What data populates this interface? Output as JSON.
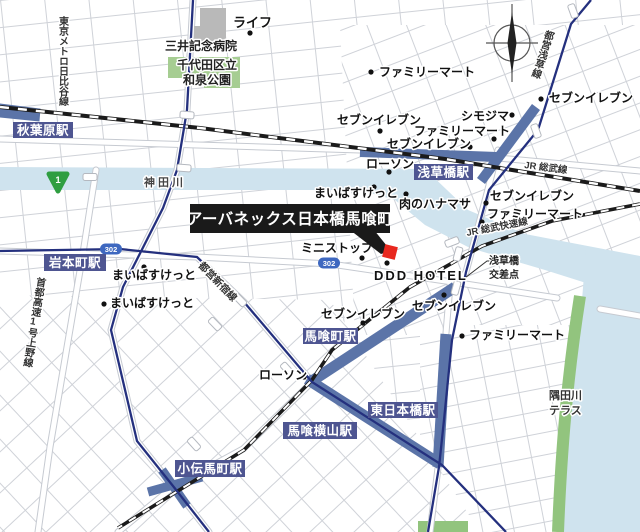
{
  "map": {
    "callout": {
      "text": "アーバネックス日本橋馬喰町"
    },
    "colors": {
      "station_box": "#4e5591",
      "band": "#5b74a8",
      "metro_line": "#24307e",
      "river": "#cfe3ee",
      "park": "#a6cd92",
      "riverside": "#92c47e",
      "marker_red": "#e8281e",
      "callout_bg": "#1a1a1a",
      "shield_green": "#2f9e41",
      "shield_blue": "#3e68c0",
      "building": "#b9b9b9"
    },
    "stations": [
      {
        "name": "秋葉原駅",
        "x": 13,
        "y": 122,
        "w": 60,
        "h": 16
      },
      {
        "name": "岩本町駅",
        "x": 44,
        "y": 254,
        "w": 62,
        "h": 17
      },
      {
        "name": "浅草橋駅",
        "x": 414,
        "y": 164,
        "w": 59,
        "h": 16
      },
      {
        "name": "馬喰町駅",
        "x": 303,
        "y": 328,
        "w": 55,
        "h": 16
      },
      {
        "name": "馬喰横山駅",
        "x": 283,
        "y": 422,
        "w": 74,
        "h": 17
      },
      {
        "name": "東日本橋駅",
        "x": 368,
        "y": 402,
        "w": 70,
        "h": 16
      },
      {
        "name": "小伝馬町駅",
        "x": 175,
        "y": 460,
        "w": 70,
        "h": 17
      }
    ],
    "pois": [
      {
        "label": "ライフ",
        "tx": 233,
        "ty": 27,
        "dx": 250,
        "dy": 33,
        "s": 13
      },
      {
        "label": "ファミリーマート",
        "tx": 379,
        "ty": 76,
        "dx": 371,
        "dy": 72
      },
      {
        "label": "セブンイレブン",
        "tx": 549,
        "ty": 102,
        "dx": 541,
        "dy": 99
      },
      {
        "label": "シモジマ",
        "tx": 461,
        "ty": 120,
        "dx": 512,
        "dy": 115
      },
      {
        "label": "セブンイレブン",
        "tx": 337,
        "ty": 124,
        "dx": 380,
        "dy": 131
      },
      {
        "label": "ファミリーマート",
        "tx": 414,
        "ty": 135,
        "dx": 494,
        "dy": 139
      },
      {
        "label": "セブンイレブン",
        "tx": 387,
        "ty": 148,
        "dx": 470,
        "dy": 147
      },
      {
        "label": "ローソン",
        "tx": 366,
        "ty": 168,
        "dx": 389,
        "dy": 172
      },
      {
        "label": "まいばすけっと",
        "tx": 314,
        "ty": 197,
        "dx": 374,
        "dy": 187
      },
      {
        "label": "肉のハナマサ",
        "tx": 399,
        "ty": 208,
        "dx": 406,
        "dy": 194
      },
      {
        "label": "セブンイレブン",
        "tx": 490,
        "ty": 200,
        "dx": 486,
        "dy": 203
      },
      {
        "label": "ファミリーマート",
        "tx": 487,
        "ty": 218,
        "dx": 482,
        "dy": 222
      },
      {
        "label": "ミニストップ",
        "tx": 301,
        "ty": 252,
        "dx": 362,
        "dy": 258
      },
      {
        "label": "DDD HOTEL",
        "tx": 374,
        "ty": 280,
        "dx": 387,
        "dy": 263,
        "s": 13,
        "ls": 2
      },
      {
        "label": "まいばすけっと",
        "tx": 112,
        "ty": 279,
        "dx": 144,
        "dy": 267
      },
      {
        "label": "まいばすけっと",
        "tx": 110,
        "ty": 307,
        "dx": 104,
        "dy": 304
      },
      {
        "label": "セブンイレブン",
        "tx": 321,
        "ty": 318,
        "dx": 363,
        "dy": 323
      },
      {
        "label": "セブンイレブン",
        "tx": 412,
        "ty": 310,
        "dx": 444,
        "dy": 295
      },
      {
        "label": "ローソン",
        "tx": 259,
        "ty": 379,
        "dx": 304,
        "dy": 377
      },
      {
        "label": "ファミリーマート",
        "tx": 469,
        "ty": 339,
        "dx": 462,
        "dy": 336
      }
    ],
    "area_labels": [
      {
        "text": "三井記念病院",
        "x": 165,
        "y": 50,
        "s": 12
      },
      {
        "text": "千代田区立",
        "x": 177,
        "y": 69,
        "s": 12
      },
      {
        "text": "和泉公園",
        "x": 183,
        "y": 84,
        "s": 12
      },
      {
        "text": "神田川",
        "x": 144,
        "y": 186,
        "s": 11,
        "ls": 3,
        "c": "#444"
      },
      {
        "text": "隅田川",
        "x": 549,
        "y": 399,
        "s": 11,
        "c": "#333"
      },
      {
        "text": "テラス",
        "x": 549,
        "y": 414,
        "s": 11,
        "c": "#333"
      },
      {
        "text": "浅草橋",
        "x": 489,
        "y": 264,
        "s": 10,
        "c": "#222"
      },
      {
        "text": "交差点",
        "x": 489,
        "y": 278,
        "s": 10,
        "c": "#222"
      }
    ],
    "line_labels": [
      {
        "text": "東京メトロ日比谷線",
        "x": 62,
        "y": 16,
        "s": 10,
        "vertical": true,
        "rotate": 0
      },
      {
        "text": "首都高速1号上野線",
        "x": 40,
        "y": 277,
        "s": 10,
        "vertical": true,
        "rotate": 9
      },
      {
        "text": "都営浅草線",
        "x": 549,
        "y": 30,
        "s": 10,
        "vertical": true,
        "rotate": 18
      },
      {
        "text": "都営新宿線",
        "x": 198,
        "y": 266,
        "s": 10,
        "rotate": 46
      },
      {
        "text": "JR 総武線",
        "x": 524,
        "y": 168,
        "s": 9.5,
        "rotate": 7
      },
      {
        "text": "JR 総武快速線",
        "x": 467,
        "y": 236,
        "s": 9.5,
        "rotate": -11
      }
    ],
    "route_shields": [
      {
        "num": "1",
        "type": "national",
        "x": 58,
        "y": 180
      },
      {
        "num": "302",
        "type": "metro",
        "x": 111,
        "y": 249
      },
      {
        "num": "302",
        "type": "metro",
        "x": 329,
        "y": 263
      }
    ]
  }
}
